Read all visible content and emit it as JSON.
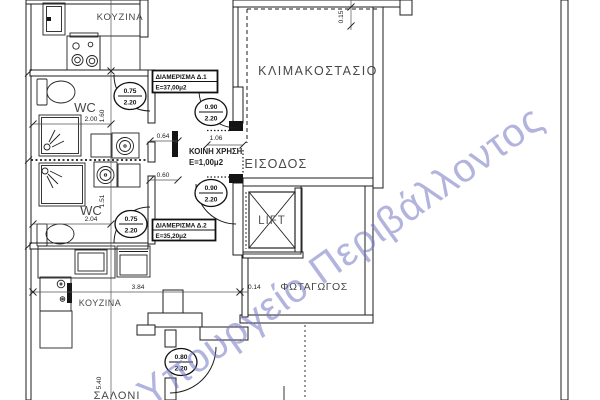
{
  "watermark": {
    "text": "Υπουργείο Περιβάλλοντος",
    "color": "#7478c2"
  },
  "rooms": {
    "kitchen1": "ΚΟΥΖΙΝΑ",
    "kitchen2": "ΚΟΥΖΙΝΑ",
    "wc1": "WC",
    "wc2": "WC",
    "stairwell": "ΚΛΙΜΑΚΟΣΤΑΣΙΟ",
    "entrance": "ΕΙΣΟΔΟΣ",
    "lift": "LIFT",
    "lightwell": "ΦΩΤΑΓΩΓΟΣ",
    "livingroom": "ΣΑΛΟΝΙ",
    "common_use": {
      "label": "ΚΟΙΝΗ ΧΡΗΣΗ",
      "area": "Ε=1,00μ2"
    }
  },
  "apartment_labels": {
    "d1": {
      "name": "ΔΙΑΜΕΡΙΣΜΑ Δ.1",
      "area": "Ε=37,00μ2"
    },
    "d2": {
      "name": "ΔΙΑΜΕΡΙΣΜΑ Δ.2",
      "area": "Ε=35,20μ2"
    }
  },
  "door_tags": {
    "wc1": {
      "width": "0.75",
      "height": "2.20"
    },
    "wc2": {
      "width": "0.75",
      "height": "2.20"
    },
    "apt1_entry": {
      "width": "0.90",
      "height": "2.20"
    },
    "apt2_entry": {
      "width": "0.90",
      "height": "2.20"
    },
    "living": {
      "width": "0.80",
      "height": "2.20"
    }
  },
  "dimensions": {
    "wc1_width": "2.00",
    "wc1_depth": "1.60",
    "wc2_width": "2.04",
    "wc2_depth": "1.51",
    "door_a": "0.64",
    "corridor_width": "1.06",
    "door_b": "0.60",
    "wall_top": "0.15",
    "kitchen_run": "3.84",
    "wall_mid": "0.14",
    "living_height": "5.40"
  },
  "colors": {
    "line": "#1c1c1c",
    "label": "#474747"
  }
}
